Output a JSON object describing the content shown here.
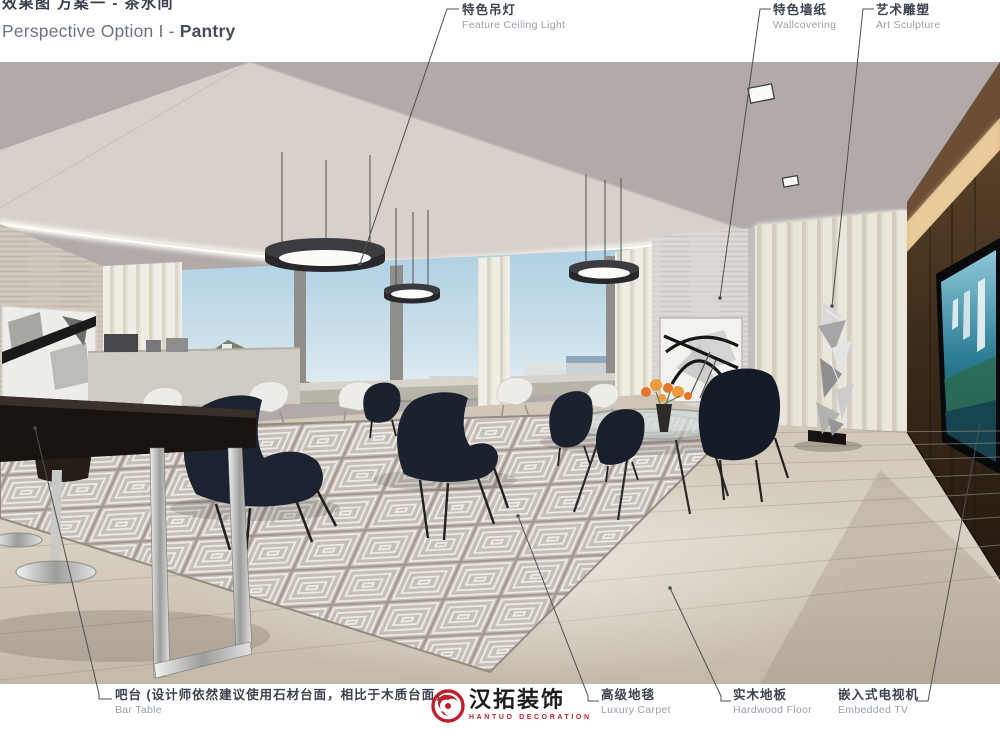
{
  "title": {
    "zh": "效果图 方案一 - 茶水间",
    "en_regular": "Perspective Option I - ",
    "en_bold": "Pantry"
  },
  "annotations": {
    "feature_ceiling_light": {
      "zh": "特色吊灯",
      "en": "Feature Ceiling Light"
    },
    "wallcovering": {
      "zh": "特色墙纸",
      "en": "Wallcovering"
    },
    "art_sculpture": {
      "zh": "艺术雕塑",
      "en": "Art Sculpture"
    },
    "bar_table": {
      "zh": "吧台 (设计师依然建议使用石材台面，相比于木质台面，石材更",
      "en": "Bar Table"
    },
    "luxury_carpet": {
      "zh": "高级地毯",
      "en": "Luxury Carpet"
    },
    "hardwood_floor": {
      "zh": "实木地板",
      "en": "Hardwood Floor"
    },
    "embedded_tv": {
      "zh": "嵌入式电视机",
      "en": "Embedded TV"
    }
  },
  "logo": {
    "cn": "汉拓装饰",
    "en": "HANTUO DECORATION"
  },
  "colors": {
    "logo_red": "#c0202e",
    "label_dark": "#3c434e",
    "label_muted": "#98a1aa",
    "leader_line": "#4f4f4f"
  }
}
